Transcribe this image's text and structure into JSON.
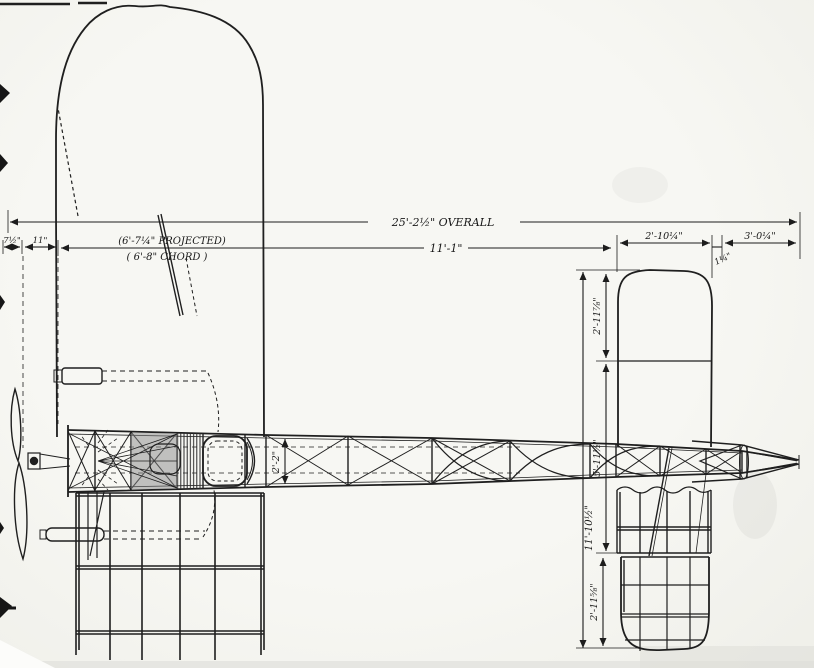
{
  "drawing": {
    "subject": "monoplane plan-view engineering drawing",
    "dimensions": {
      "overall": "25'-2½\" OVERALL",
      "fuselage_rear": "11'-1\"",
      "chord_projected": "(6'-7¼\" PROJECTED)",
      "chord_actual": "( 6'-8\" CHORD )",
      "prop_offset": "7½\"",
      "prop_to_wing": "11\"",
      "stabilizer_chord": "2'-10¼\"",
      "hinge_gap": "1¼\"",
      "rudder_length": "3'-0¼\"",
      "fuselage_width": "2'-2\"",
      "tail_tip_upper": "2'-11⅞\"",
      "stabilizer_center": "5'-11½\"",
      "tail_span_overall": "11'-10½\"",
      "tail_tip_lower": "2'-11⅝\""
    },
    "ink_color": "#1f1f1f",
    "paper_color": "#f5f5f2"
  }
}
